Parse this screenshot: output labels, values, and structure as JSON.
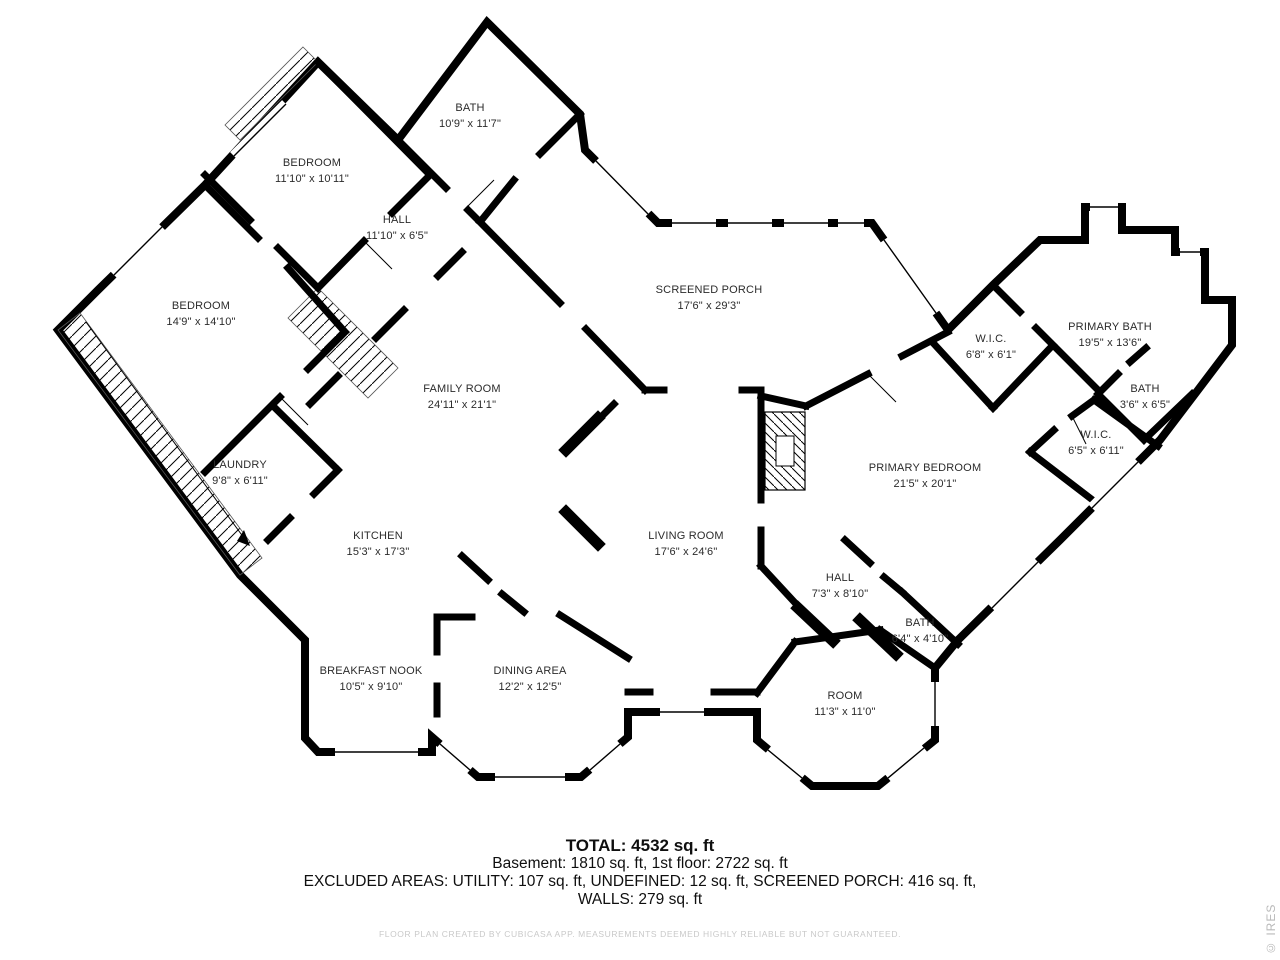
{
  "rooms": [
    {
      "id": "bath-upper",
      "name": "BATH",
      "dims": "10'9\" x 11'7\""
    },
    {
      "id": "bedroom-upper",
      "name": "BEDROOM",
      "dims": "11'10\" x 10'11\""
    },
    {
      "id": "hall-upper",
      "name": "HALL",
      "dims": "11'10\" x 6'5\""
    },
    {
      "id": "bedroom-left",
      "name": "BEDROOM",
      "dims": "14'9\" x 14'10\""
    },
    {
      "id": "screened-porch",
      "name": "SCREENED PORCH",
      "dims": "17'6\" x 29'3\""
    },
    {
      "id": "family-room",
      "name": "FAMILY ROOM",
      "dims": "24'11\" x 21'1\""
    },
    {
      "id": "wic-upper",
      "name": "W.I.C.",
      "dims": "6'8\" x 6'1\""
    },
    {
      "id": "primary-bath",
      "name": "PRIMARY BATH",
      "dims": "19'5\" x 13'6\""
    },
    {
      "id": "bath-small",
      "name": "BATH",
      "dims": "3'6\" x 6'5\""
    },
    {
      "id": "wic-lower",
      "name": "W.I.C.",
      "dims": "6'5\" x 6'11\""
    },
    {
      "id": "primary-bedroom",
      "name": "PRIMARY BEDROOM",
      "dims": "21'5\" x 20'1\""
    },
    {
      "id": "laundry",
      "name": "LAUNDRY",
      "dims": "9'8\" x 6'11\""
    },
    {
      "id": "kitchen",
      "name": "KITCHEN",
      "dims": "15'3\" x 17'3\""
    },
    {
      "id": "living-room",
      "name": "LIVING ROOM",
      "dims": "17'6\" x 24'6\""
    },
    {
      "id": "hall-lower",
      "name": "HALL",
      "dims": "7'3\" x 8'10\""
    },
    {
      "id": "bath-lower",
      "name": "BATH",
      "dims": "6'4\" x 4'10\""
    },
    {
      "id": "breakfast-nook",
      "name": "BREAKFAST NOOK",
      "dims": "10'5\" x 9'10\""
    },
    {
      "id": "dining-area",
      "name": "DINING AREA",
      "dims": "12'2\" x 12'5\""
    },
    {
      "id": "room",
      "name": "ROOM",
      "dims": "11'3\" x 11'0\""
    }
  ],
  "summary": {
    "total": "TOTAL: 4532 sq. ft",
    "floors": "Basement: 1810 sq. ft, 1st floor: 2722 sq. ft",
    "excluded": "EXCLUDED AREAS: UTILITY: 107 sq. ft, UNDEFINED: 12 sq. ft, SCREENED PORCH: 416 sq. ft,",
    "walls": "WALLS: 279 sq. ft"
  },
  "disclaimer": "FLOOR PLAN CREATED BY CUBICASA APP. MEASUREMENTS DEEMED HIGHLY RELIABLE BUT NOT GUARANTEED.",
  "watermark": "© IRES",
  "colors": {
    "wall": "#000000",
    "background": "#ffffff",
    "label": "#2b2b2b",
    "muted": "#c9c9c9"
  }
}
